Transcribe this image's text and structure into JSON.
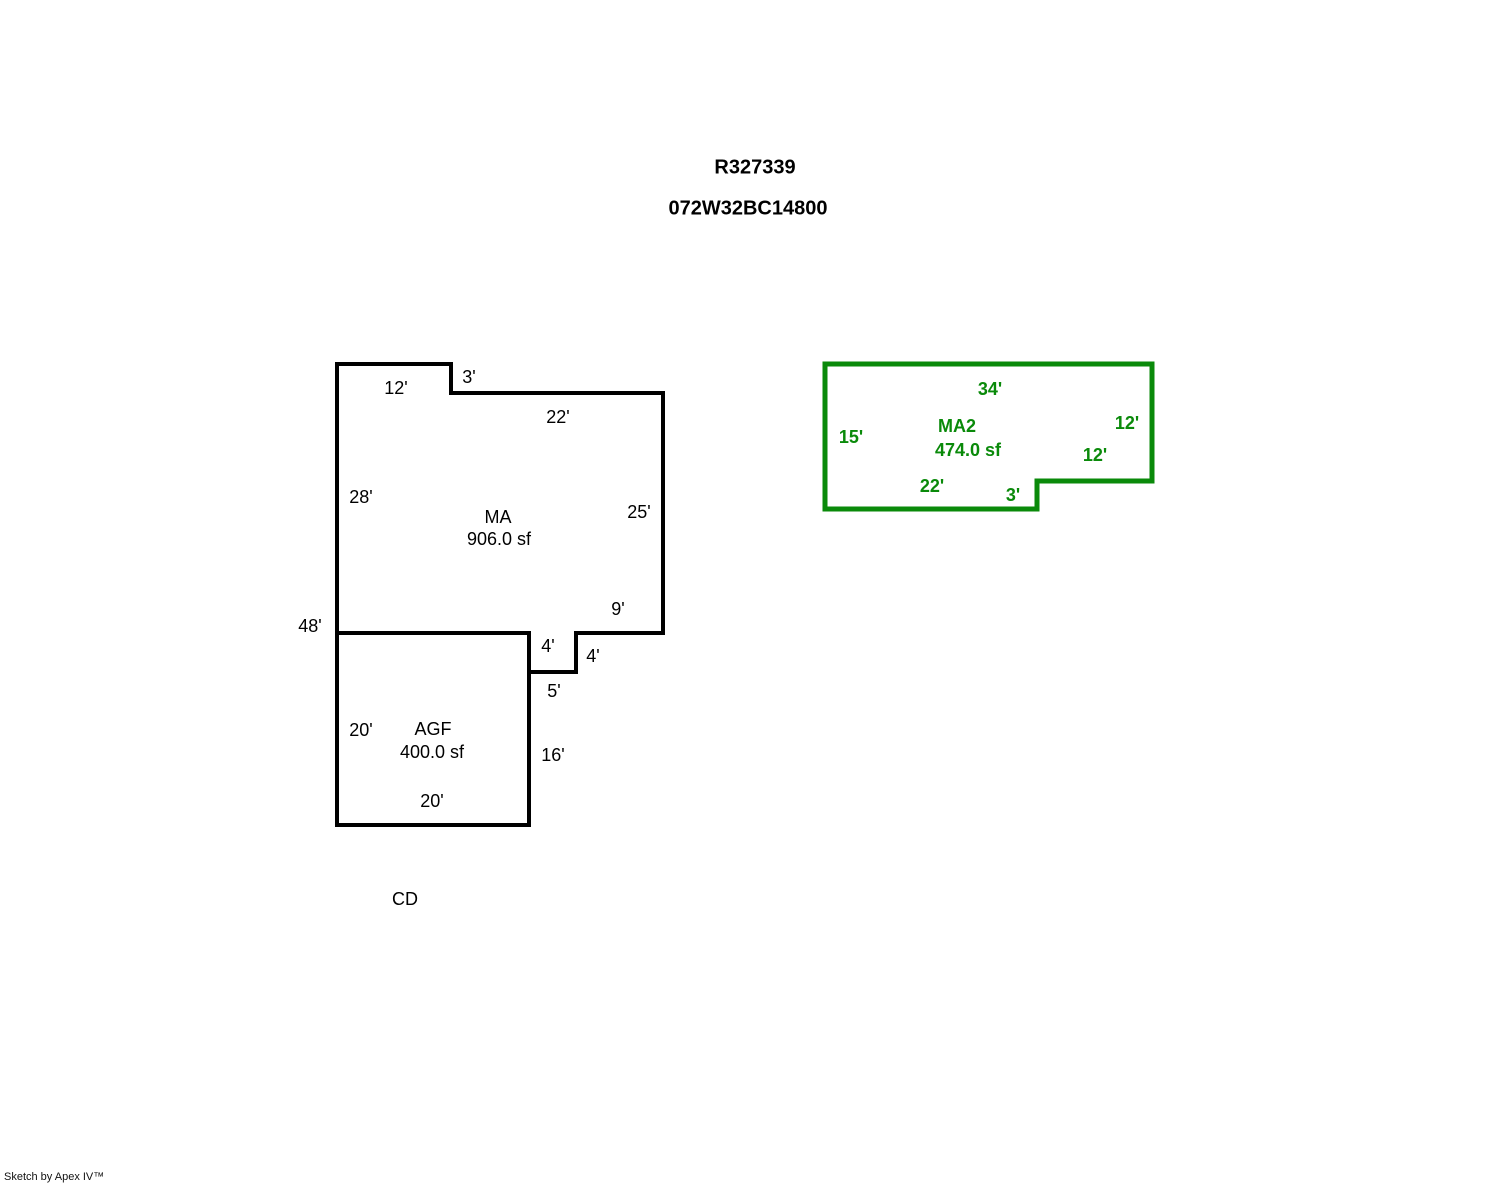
{
  "page": {
    "title_line1": "R327339",
    "title_line2": "072W32BC14800",
    "footer_credit": "Sketch by Apex IV™"
  },
  "colors": {
    "primary_outline": "#000000",
    "secondary_outline": "#0a8a0a",
    "background": "#ffffff"
  },
  "areas": {
    "ma": {
      "label": "MA",
      "area": "906.0 sf",
      "dims": {
        "top_left": "12'",
        "top_step": "3'",
        "top_right": "22'",
        "left": "28'",
        "right": "25'",
        "bottom_right": "9'",
        "notch_inner": "4'",
        "notch_outer": "4'",
        "notch_bottom": "5'",
        "left_overall": "48'"
      }
    },
    "agf": {
      "label": "AGF",
      "area": "400.0 sf",
      "dims": {
        "left": "20'",
        "right": "16'",
        "bottom": "20'"
      }
    },
    "cd_label": "CD",
    "ma2": {
      "label": "MA2",
      "area": "474.0 sf",
      "dims": {
        "top": "34'",
        "left": "15'",
        "right": "12'",
        "step_top": "12'",
        "bottom": "22'",
        "step_side": "3'"
      }
    }
  }
}
